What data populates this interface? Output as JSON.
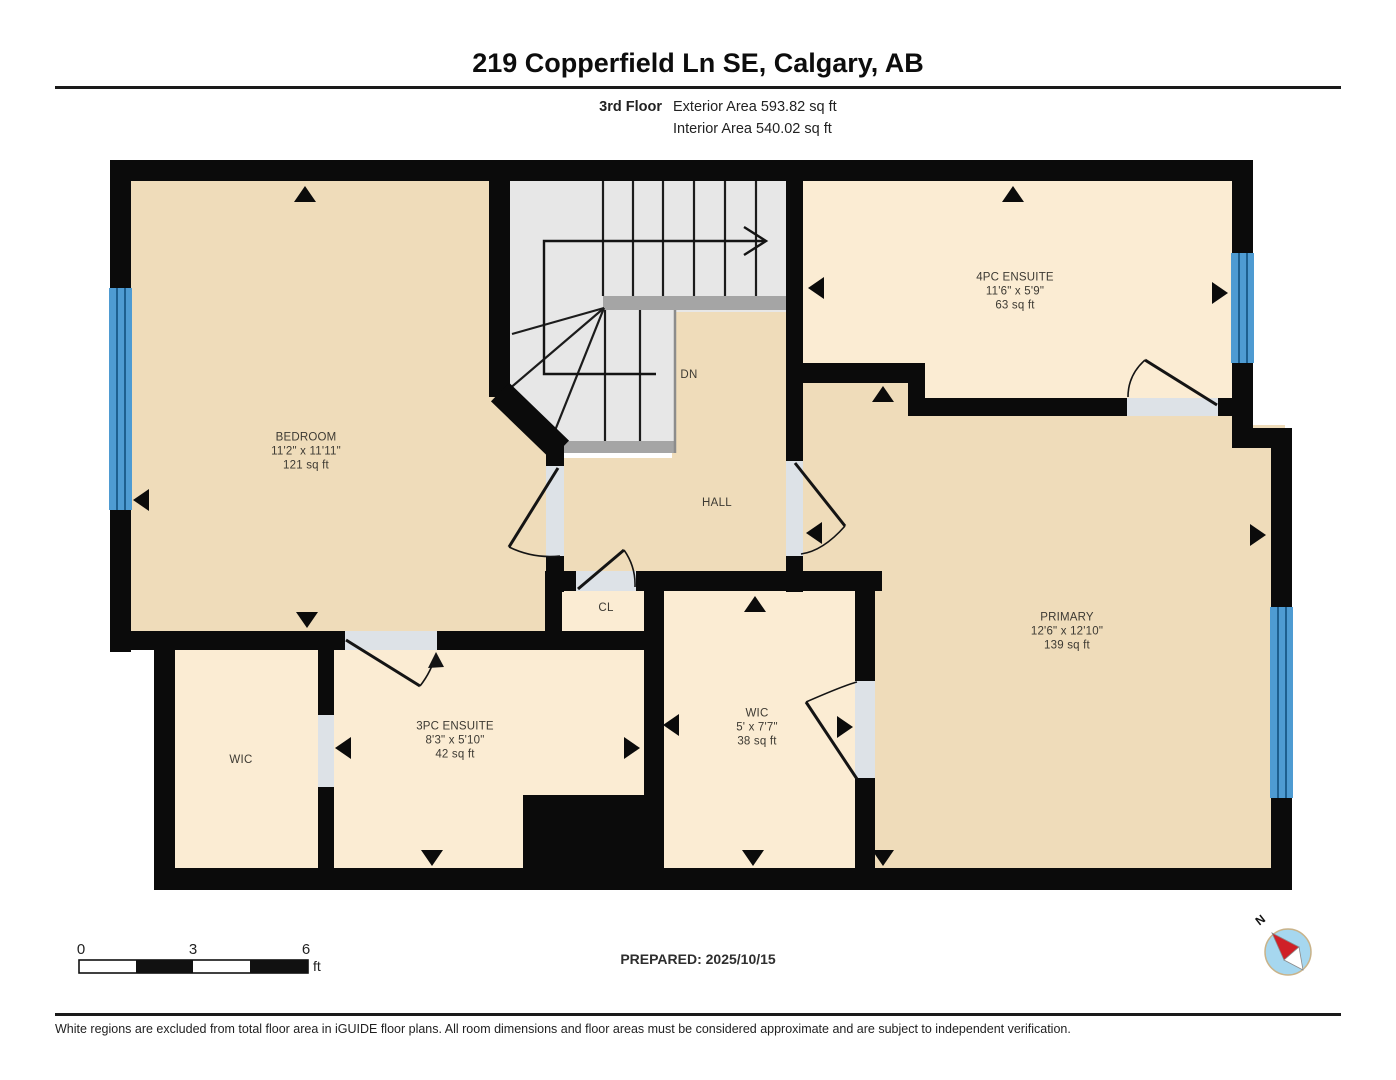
{
  "header": {
    "title": "219 Copperfield Ln SE, Calgary, AB",
    "floor_label": "3rd Floor",
    "exterior_area": "Exterior Area 593.82 sq ft",
    "interior_area": "Interior Area 540.02 sq ft"
  },
  "rooms": [
    {
      "id": "bedroom",
      "name": "BEDROOM",
      "dimensions": "11'2\" x 11'11\"",
      "area": "121 sq ft"
    },
    {
      "id": "ensuite4pc",
      "name": "4PC ENSUITE",
      "dimensions": "11'6\" x 5'9\"",
      "area": "63 sq ft"
    },
    {
      "id": "primary",
      "name": "PRIMARY",
      "dimensions": "12'6\" x 12'10\"",
      "area": "139 sq ft"
    },
    {
      "id": "ensuite3pc",
      "name": "3PC ENSUITE",
      "dimensions": "8'3\" x 5'10\"",
      "area": "42 sq ft"
    },
    {
      "id": "wic_center",
      "name": "WIC",
      "dimensions": "5' x 7'7\"",
      "area": "38 sq ft"
    }
  ],
  "labels": {
    "hall": "HALL",
    "closet": "CL",
    "stairs_down": "DN",
    "wic_left": "WIC"
  },
  "scale_bar": {
    "start": "0",
    "mid": "3",
    "end": "6",
    "unit": "ft"
  },
  "prepared": "PREPARED: 2025/10/15",
  "compass": {
    "north_label": "N"
  },
  "footer": "White regions are excluded from total floor area in iGUIDE floor plans. All room dimensions and floor areas must be considered approximate and are subject to independent verification.",
  "colors": {
    "room_tan": "#efdcba",
    "room_cream": "#fbecd3",
    "stair_gray": "#e7e7e7",
    "landing_gray": "#a5a5a5",
    "window_blue": "#4e9bd2",
    "wall_black": "#0b0b0b",
    "opening_gray": "#dde2e7"
  }
}
